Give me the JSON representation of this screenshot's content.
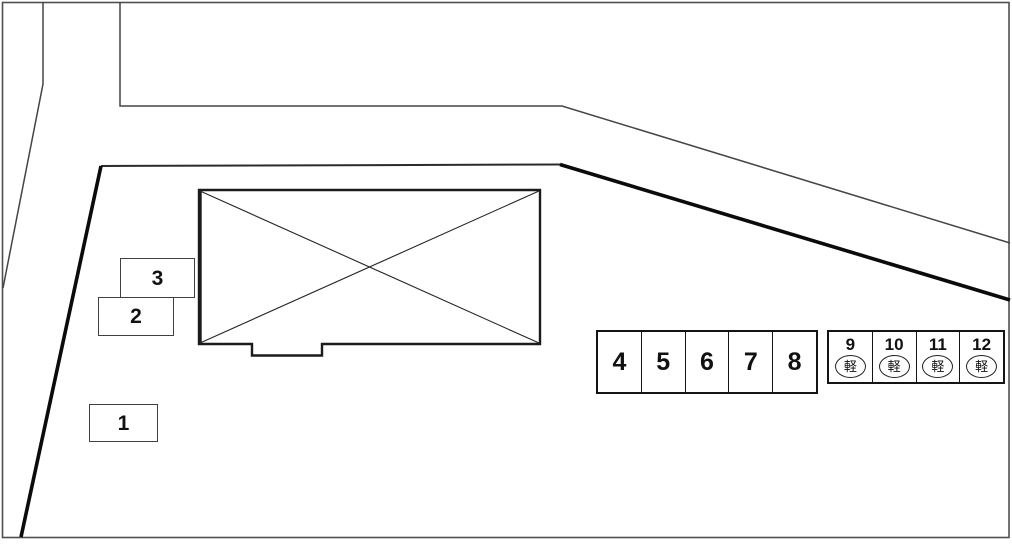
{
  "diagram": {
    "kind": "parking-lot-layout",
    "colors": {
      "background": "#ffffff",
      "thin_line": "#454545",
      "boundary_line": "#0b0b0b",
      "building_line": "#1b1b1b",
      "text": "#111111"
    }
  },
  "spaces": {
    "standalone": [
      {
        "label": "1"
      },
      {
        "label": "2"
      },
      {
        "label": "3"
      }
    ],
    "row_standard": [
      {
        "label": "4"
      },
      {
        "label": "5"
      },
      {
        "label": "6"
      },
      {
        "label": "7"
      },
      {
        "label": "8"
      }
    ],
    "row_kei": [
      {
        "number": "9",
        "badge": "軽"
      },
      {
        "number": "10",
        "badge": "軽"
      },
      {
        "number": "11",
        "badge": "軽"
      },
      {
        "number": "12",
        "badge": "軽"
      }
    ]
  }
}
